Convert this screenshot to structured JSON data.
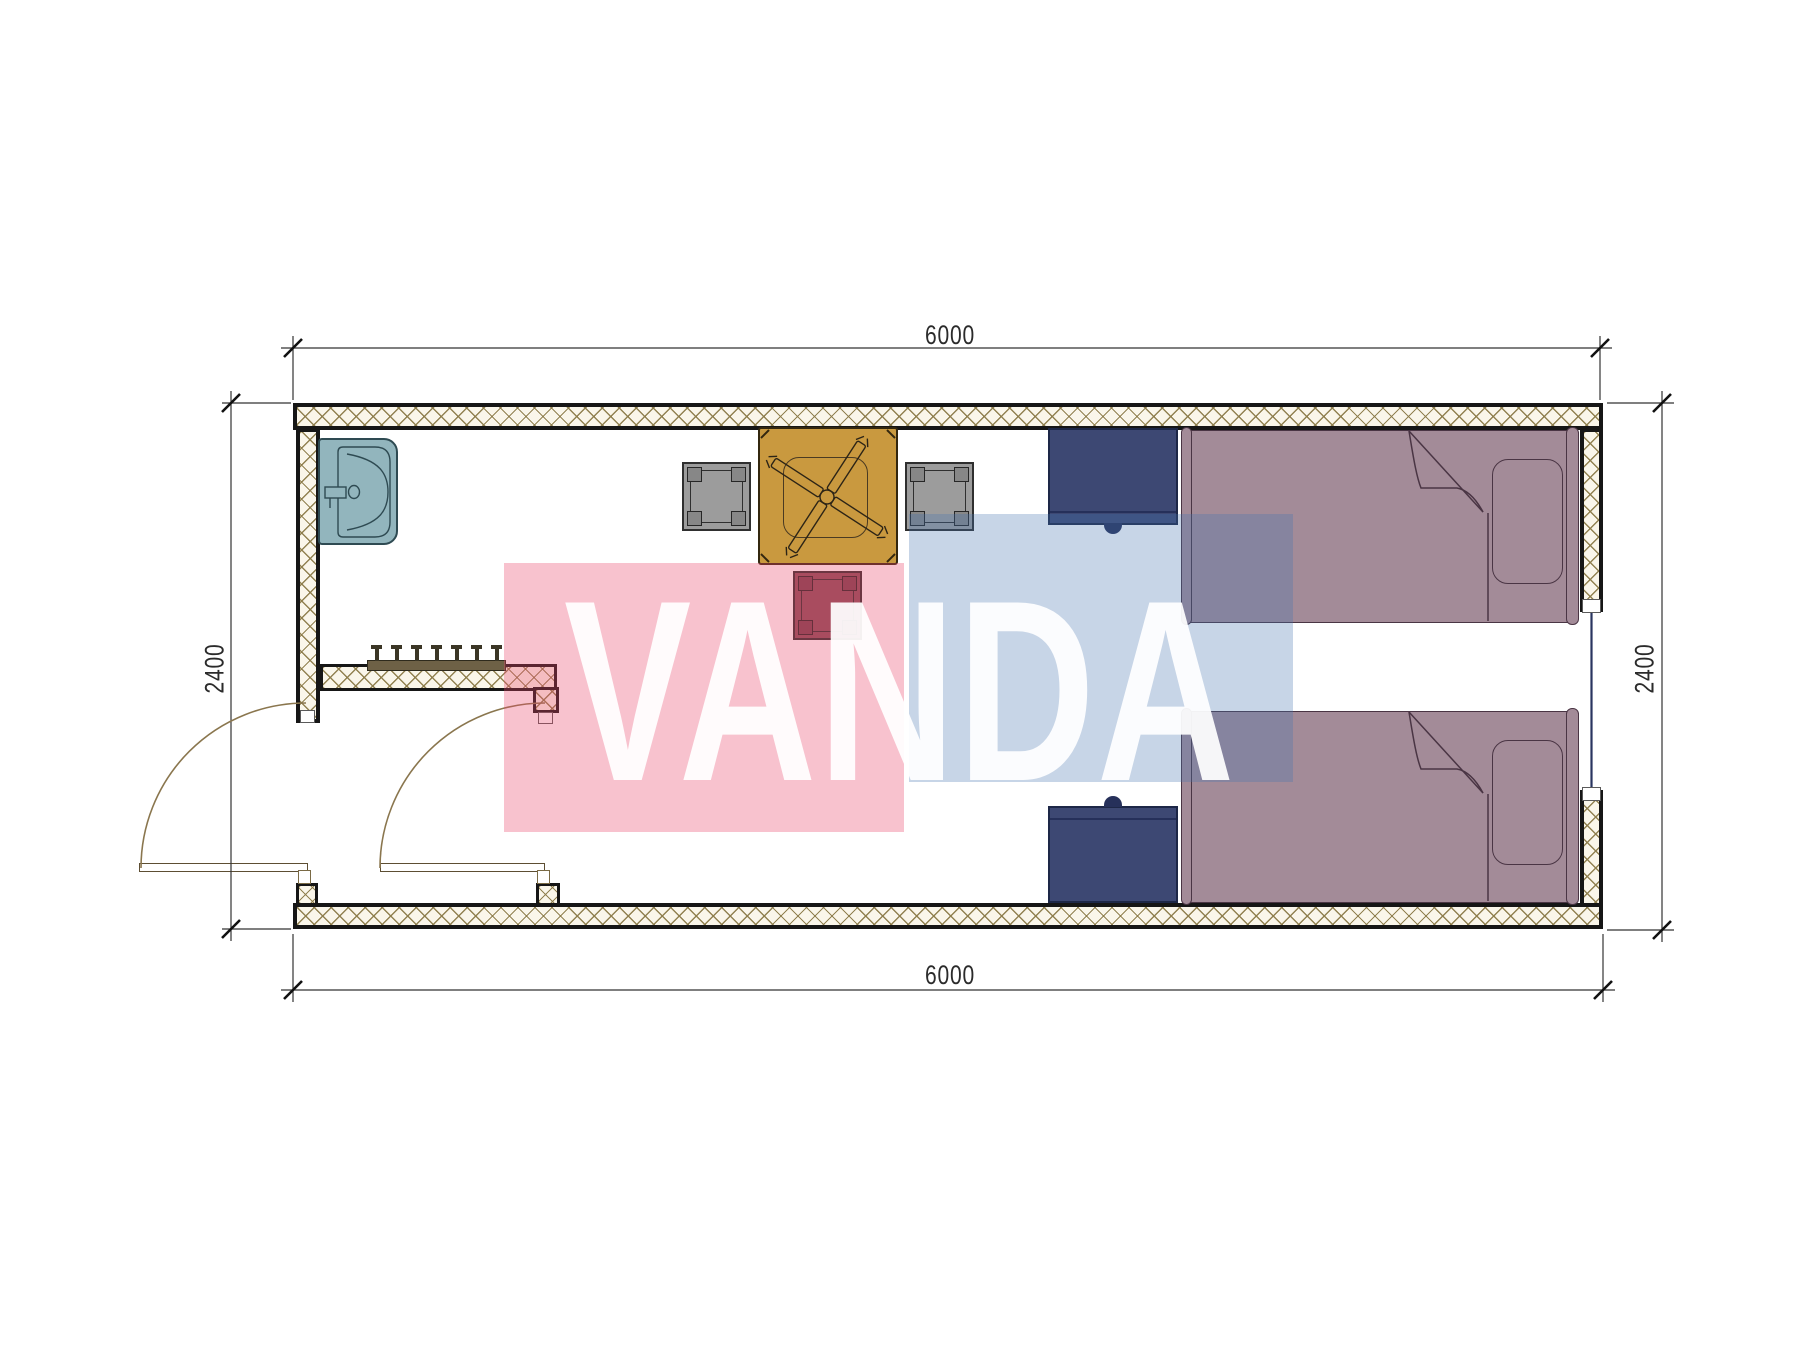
{
  "drawing": {
    "type": "architectural floor plan",
    "subject": "prefab container room with two single beds, entry vestibule and sink",
    "units": "mm"
  },
  "dimensions": {
    "top": "6000",
    "bottom": "6000",
    "left": "2400",
    "right": "2400"
  },
  "watermark": {
    "text": "VANDA",
    "pink_block_color": "#EB4669",
    "blue_block_color": "#4673AF",
    "text_color": "#FFFFFF"
  },
  "plan_items": {
    "sink": "wash basin with faucet, top-left corner",
    "table": "square pedestal table with X-shaped base, against top wall",
    "chairs": [
      "gray side chair left",
      "gray side chair right",
      "maroon side chair bottom"
    ],
    "coat_rack": "wall rack with 7 hooks above vestibule partition",
    "nightstands": [
      "navy nightstand at top wall",
      "navy nightstand at bottom wall"
    ],
    "beds": [
      "single bed top with pillow and folded blanket",
      "single bed bottom with pillow and folded blanket"
    ],
    "doors": [
      "exterior swing door at west opening",
      "vestibule swing door"
    ],
    "window": "glazed opening in right wall between beds"
  },
  "colors": {
    "wall_fill": "#FAF6EA",
    "wall_hatch": "#8C7C4A",
    "wall_outline": "#161616",
    "sink": "#92B5BD",
    "table": "#C9993F",
    "chair_gray": "#9C9C9C",
    "chair_accent": "#8A4F5A",
    "nightstand": "#3D4873",
    "bed": "#A38B98",
    "door_arc": "#8A764E",
    "dimension_line": "#333333"
  }
}
